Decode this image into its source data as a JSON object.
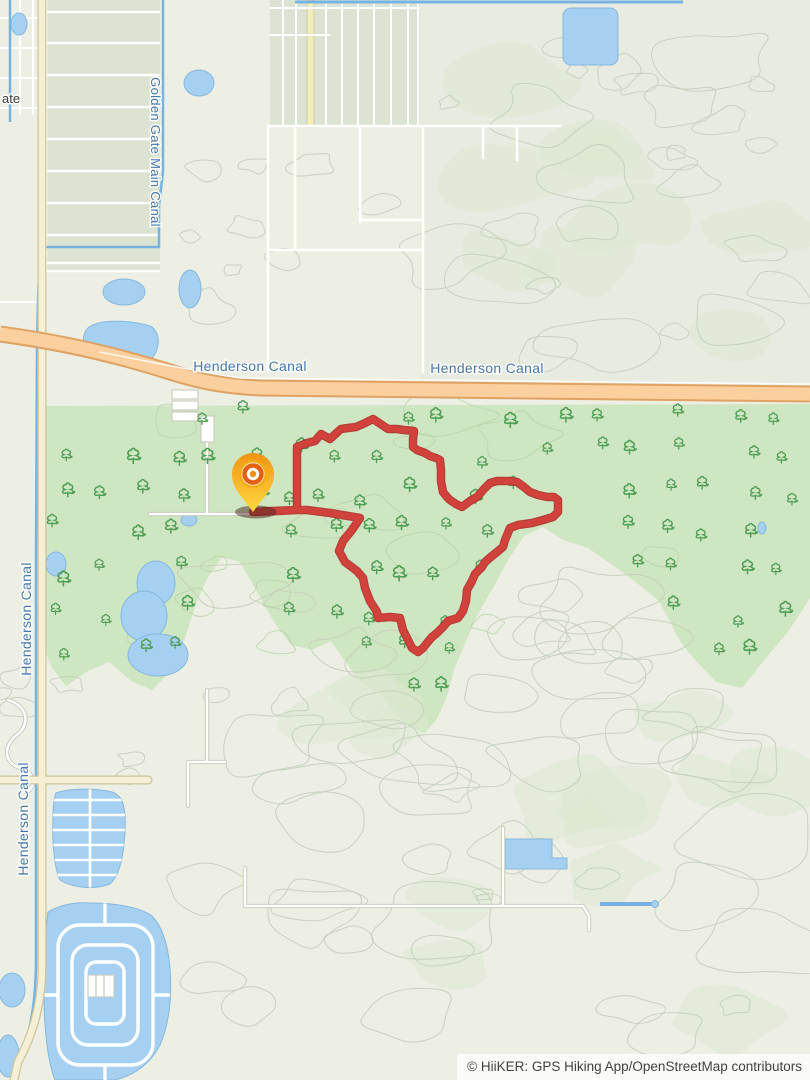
{
  "map": {
    "attribution": "© HiiKER: GPS Hiking App/OpenStreetMap contributors",
    "labels": {
      "partial_place": "ate",
      "golden_gate_main_canal": "Golden Gate Main Canal",
      "henderson_canal_road_1": "Henderson Canal",
      "henderson_canal_road_2": "Henderson Canal",
      "henderson_canal_left_upper": "Henderson Canal",
      "henderson_canal_left_lower": "Henderson Canal"
    },
    "trail": {
      "points": "253,512 272,511 297,510 307,510 330,513 348,516 360,518 352,530 343,541 339,551 345,562 357,571 363,578 365,588 370,601 377,612 378,618 390,617 400,618 403,630 408,640 412,648 418,652 423,648 427,643 432,637 437,633 443,627 448,621 458,618 463,611 466,601 467,590 472,581 475,574 482,567 485,562 492,556 497,552 503,547 505,540 510,528 518,525 532,523 543,520 553,517 558,512 558,500 554,497 547,497 538,495 530,492 524,487 517,482 510,481 503,481 497,481 490,483 484,489 477,497 470,501 462,507 456,504 450,500 447,497 443,492 441,481 441,470 440,460 436,458 430,456 425,453 417,450 413,447 413,439 414,431 404,430 397,429 388,429 382,425 373,419 363,424 356,427 348,428 341,429 330,439 321,434 315,441 307,443 297,447 297,478 297,510 278,511 253,512",
      "start": {
        "x": 253,
        "y": 512
      }
    },
    "marker": {
      "type": "trail-start-pin",
      "x": 253,
      "y": 512
    },
    "colors": {
      "ground": "#edefe4",
      "forest": "#cfe6c2",
      "contour": "#c6d1bd",
      "water": "#a6d0f2",
      "water_line": "#76b3e3",
      "highway_fill": "#fbd09e",
      "highway_casing": "#e0a263",
      "road_beige": "#f5efd5",
      "label_water": "#4779ad",
      "tree": "#4f9e55",
      "trail": "#d2423c"
    }
  }
}
